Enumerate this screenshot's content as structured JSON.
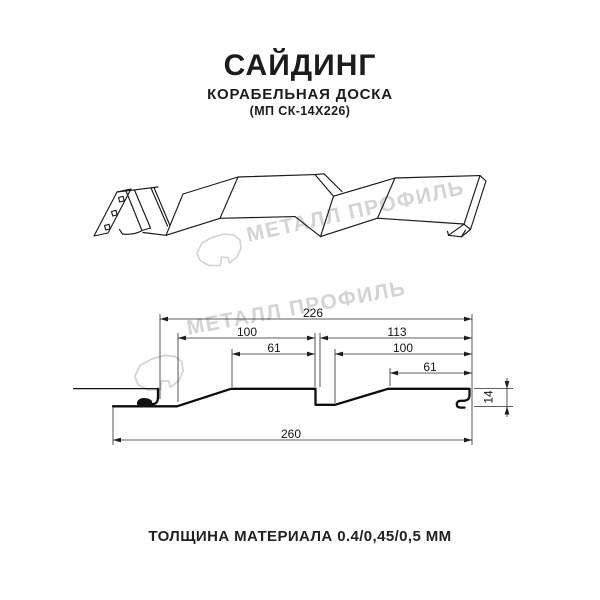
{
  "header": {
    "title": "САЙДИНГ",
    "subtitle": "КОРАБЕЛЬНАЯ ДОСКА",
    "model": "(МП СК-14Х226)"
  },
  "watermark": {
    "text": "МЕТАЛЛ ПРОФИЛЬ"
  },
  "section": {
    "dims": {
      "w226": "226",
      "l100": "100",
      "r113": "113",
      "l61": "61",
      "r100": "100",
      "r61": "61",
      "b260": "260",
      "h14": "14"
    }
  },
  "footer": {
    "thickness": "ТОЛЩИНА МАТЕРИАЛА 0.4/0,45/0,5 ММ"
  }
}
